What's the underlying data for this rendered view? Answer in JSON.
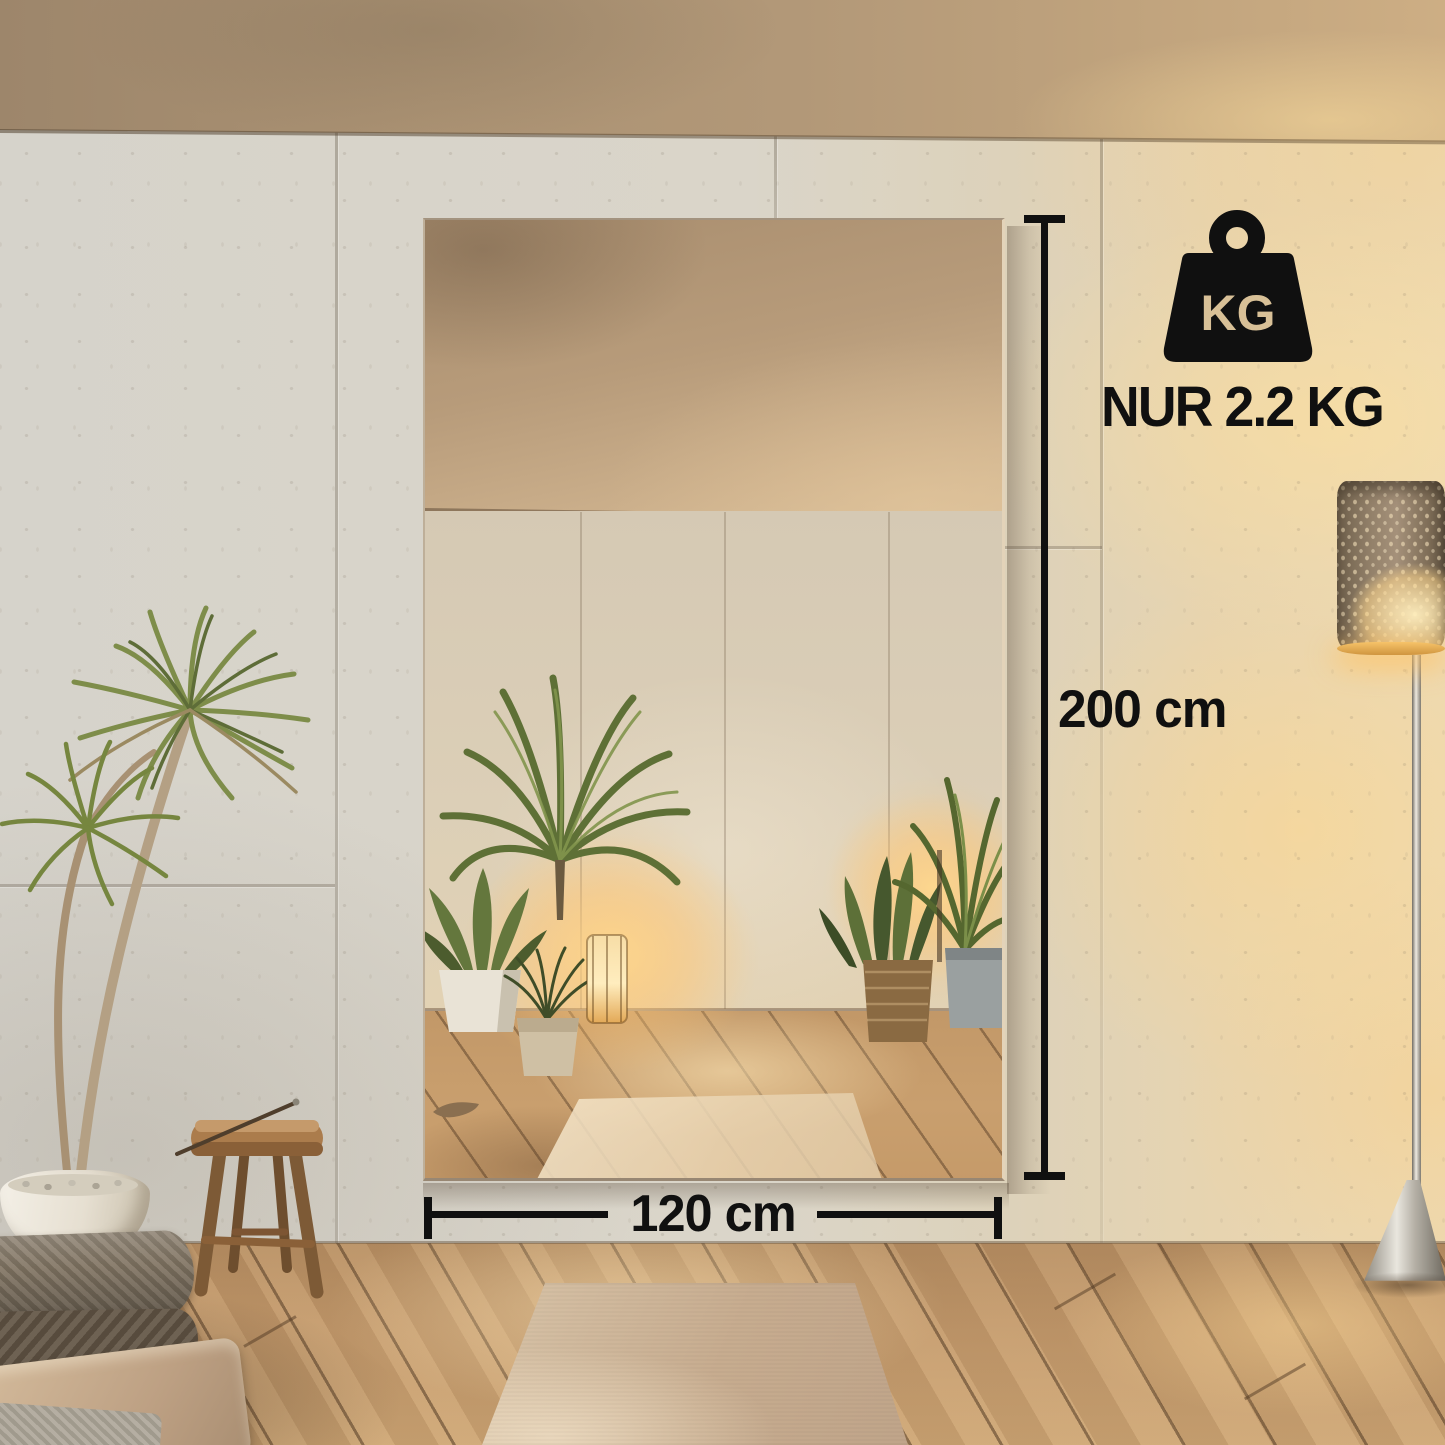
{
  "annotations": {
    "weight_badge": {
      "icon": "weight-kg-icon",
      "icon_label": "KG",
      "caption": "NUR 2.2 KG"
    },
    "height_dimension": {
      "label": "200 cm"
    },
    "width_dimension": {
      "label": "120 cm"
    },
    "colors": {
      "ink": "#101010",
      "kg_text": "#d8c097",
      "lamp_glow": "#f6c369"
    }
  }
}
